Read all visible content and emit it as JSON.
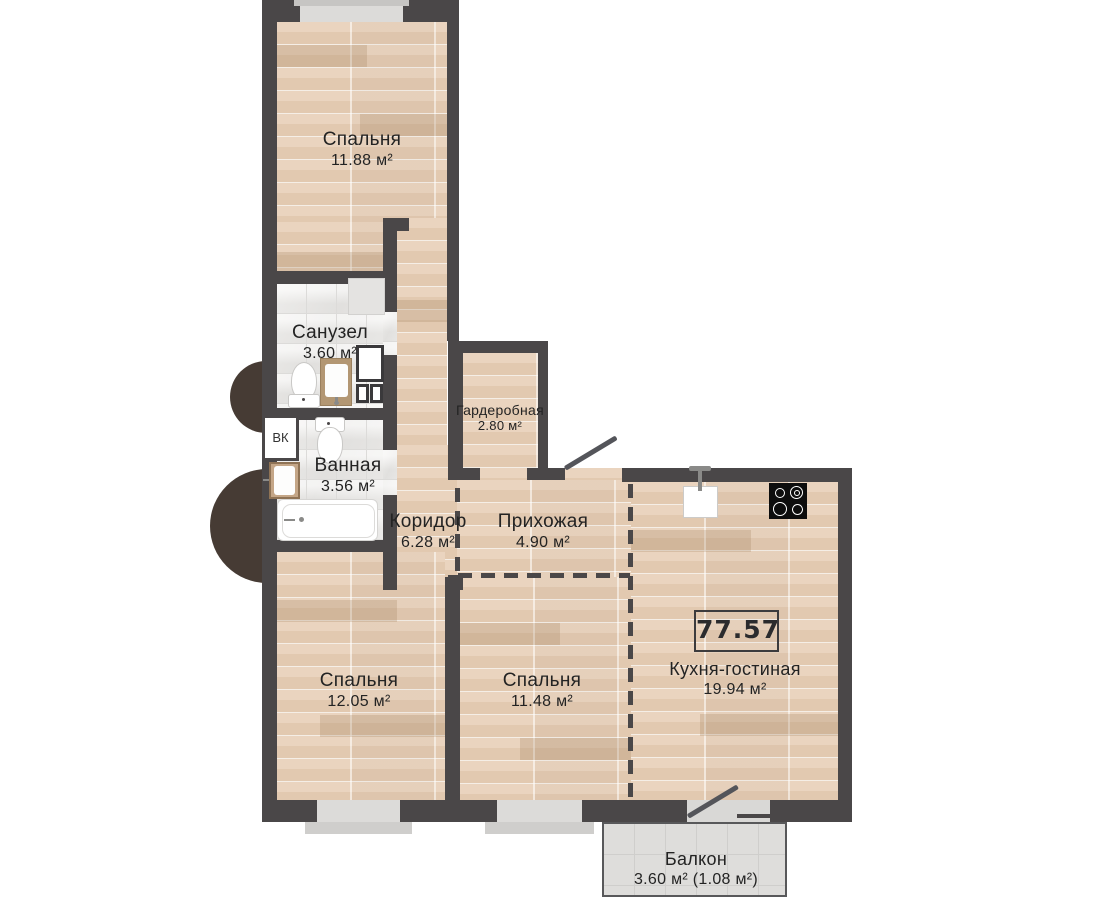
{
  "plan": {
    "total_area_badge": "77.57",
    "rooms": {
      "bedroom_top": {
        "name": "Спальня",
        "area": "11.88 м²"
      },
      "sanuzel": {
        "name": "Санузел",
        "area": "3.60 м²"
      },
      "vannaya": {
        "name": "Ванная",
        "area": "3.56 м²"
      },
      "vk": {
        "name": "ВК"
      },
      "garderobnaya": {
        "name": "Гардеробная",
        "area": "2.80 м²"
      },
      "koridor": {
        "name": "Коридор",
        "area": "6.28 м²"
      },
      "prihozhaya": {
        "name": "Прихожая",
        "area": "4.90 м²"
      },
      "bedroom_left": {
        "name": "Спальня",
        "area": "12.05 м²"
      },
      "bedroom_middle": {
        "name": "Спальня",
        "area": "11.48 м²"
      },
      "kitchen_living": {
        "name": "Кухня-гостиная",
        "area": "19.94 м²"
      },
      "balcony": {
        "name": "Балкон",
        "area": "3.60 м² (1.08 м²)"
      }
    },
    "colors": {
      "wall": "#4a4748",
      "wood_floor": "#e6cfb8",
      "tile_floor": "#f1f0ee",
      "balcony_tile": "#dedddb",
      "exterior_accent": "#463b34"
    }
  }
}
